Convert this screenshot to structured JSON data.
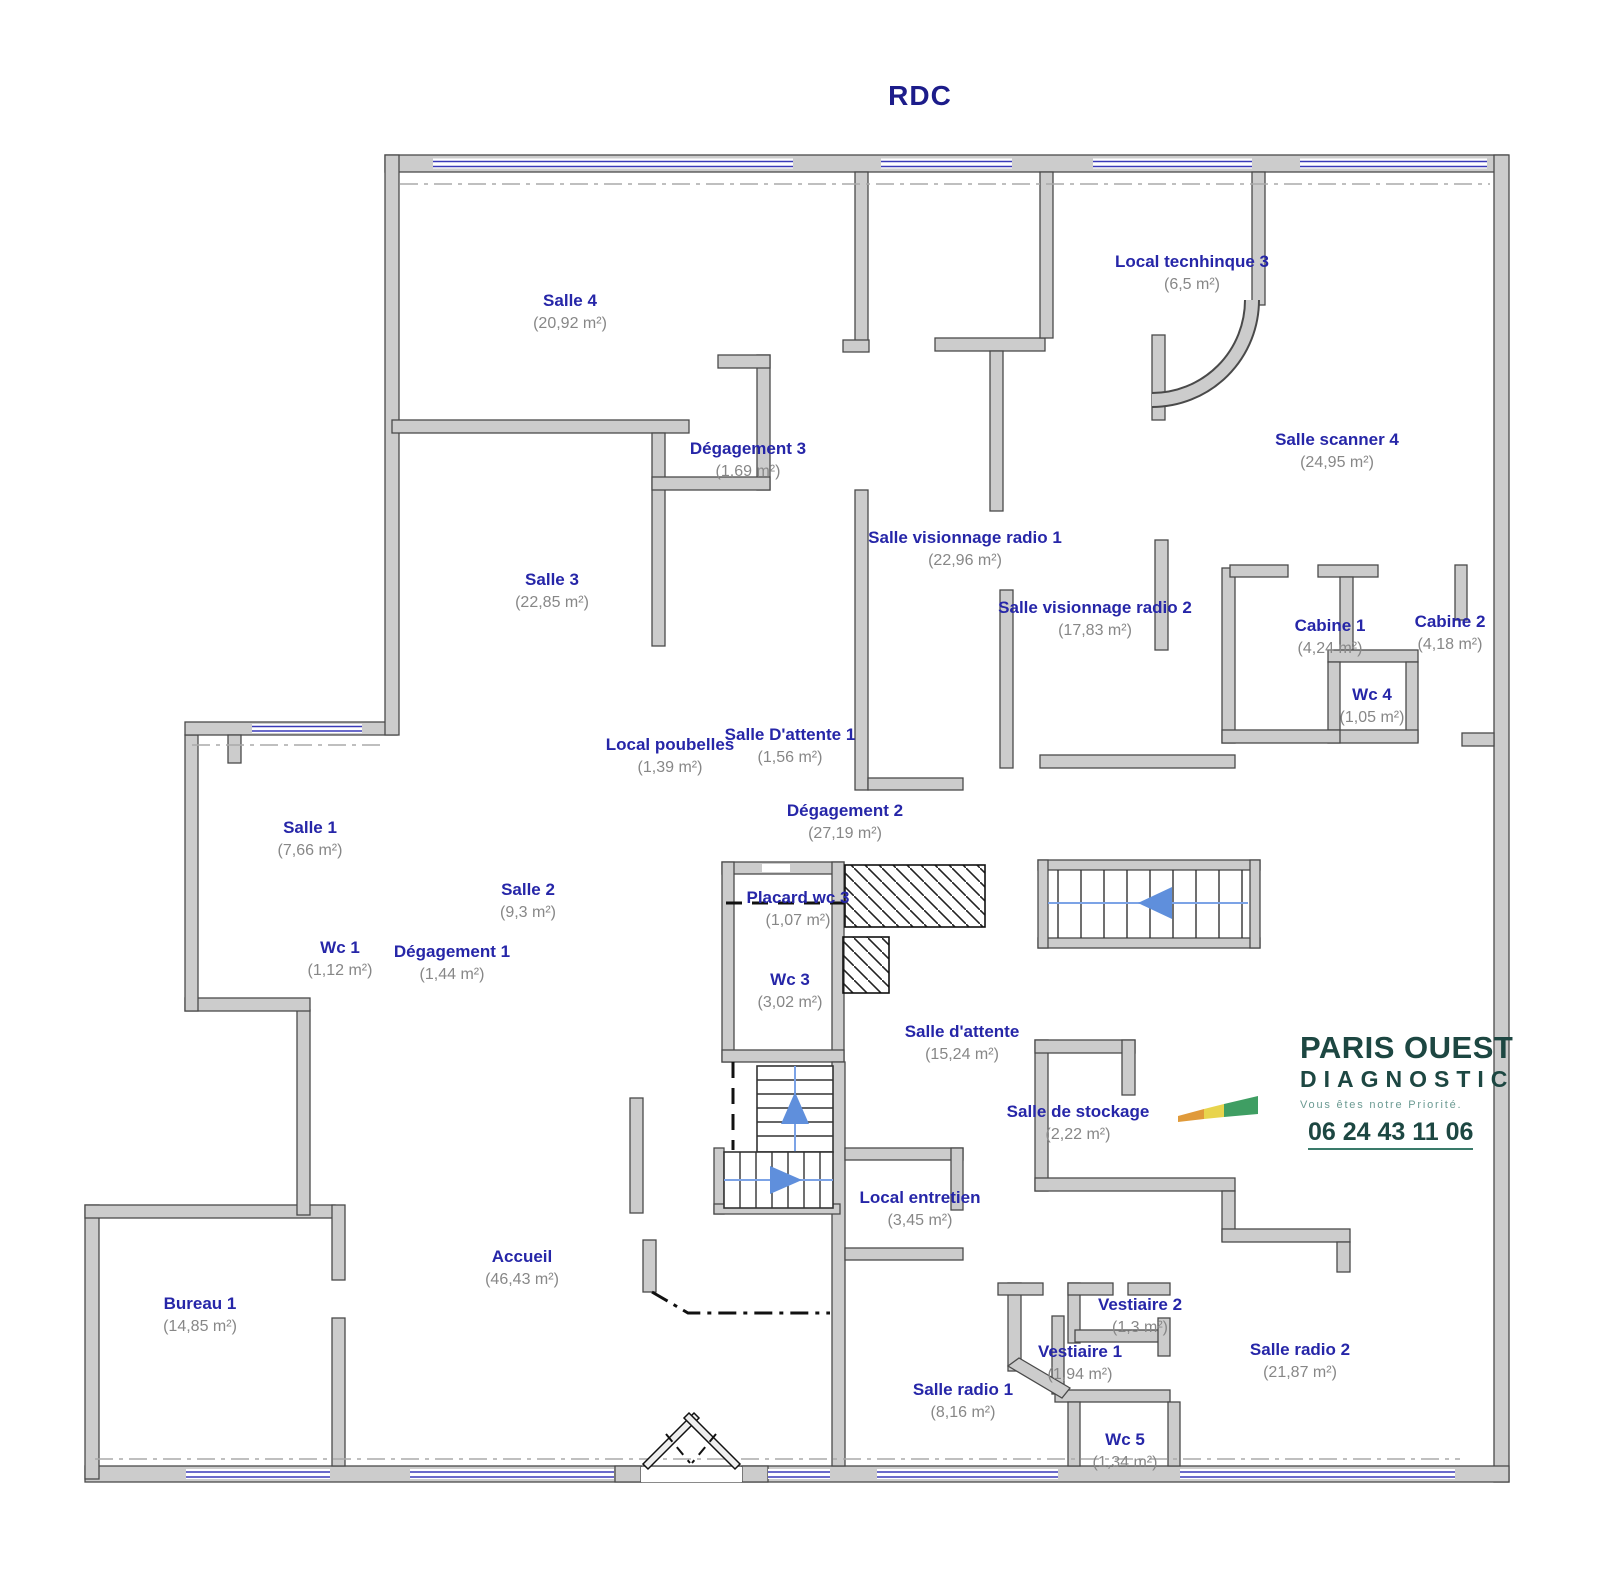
{
  "title": "RDC",
  "rooms": [
    {
      "id": "salle-4",
      "name": "Salle  4",
      "area": "(20,92 m²)",
      "cx": 570,
      "y": 289
    },
    {
      "id": "local-tecnhinque-3",
      "name": "Local tecnhinque 3",
      "area": "(6,5 m²)",
      "cx": 1192,
      "y": 250
    },
    {
      "id": "salle-scanner-4",
      "name": "Salle scanner 4",
      "area": "(24,95 m²)",
      "cx": 1337,
      "y": 428
    },
    {
      "id": "degagement-3",
      "name": "Dégagement 3",
      "area": "(1,69 m²)",
      "cx": 748,
      "y": 437
    },
    {
      "id": "salle-visionnage-radio-1",
      "name": "Salle visionnage radio 1",
      "area": "(22,96 m²)",
      "cx": 965,
      "y": 526
    },
    {
      "id": "salle-3",
      "name": "Salle 3",
      "area": "(22,85 m²)",
      "cx": 552,
      "y": 568
    },
    {
      "id": "salle-visionnage-radio-2",
      "name": "Salle visionnage radio 2",
      "area": "(17,83 m²)",
      "cx": 1095,
      "y": 596
    },
    {
      "id": "cabine-1",
      "name": "Cabine 1",
      "area": "(4,24 m²)",
      "cx": 1330,
      "y": 614
    },
    {
      "id": "cabine-2",
      "name": "Cabine 2",
      "area": "(4,18 m²)",
      "cx": 1450,
      "y": 610
    },
    {
      "id": "wc-4",
      "name": "Wc 4",
      "area": "(1,05 m²)",
      "cx": 1372,
      "y": 683
    },
    {
      "id": "local-poubelles",
      "name": "Local poubelles",
      "area": "(1,39 m²)",
      "cx": 670,
      "y": 733
    },
    {
      "id": "salle-d-attente-1",
      "name": "Salle D'attente  1",
      "area": "(1,56 m²)",
      "cx": 790,
      "y": 723
    },
    {
      "id": "degagement-2",
      "name": "Dégagement 2",
      "area": "(27,19 m²)",
      "cx": 845,
      "y": 799
    },
    {
      "id": "salle-1",
      "name": "Salle 1",
      "area": "(7,66 m²)",
      "cx": 310,
      "y": 816
    },
    {
      "id": "salle-2",
      "name": "Salle 2",
      "area": "(9,3 m²)",
      "cx": 528,
      "y": 878
    },
    {
      "id": "wc-1",
      "name": "Wc 1",
      "area": "(1,12 m²)",
      "cx": 340,
      "y": 936
    },
    {
      "id": "degagement-1",
      "name": "Dégagement 1",
      "area": "(1,44 m²)",
      "cx": 452,
      "y": 940
    },
    {
      "id": "placard-wc-3",
      "name": "Placard wc 3",
      "area": "(1,07 m²)",
      "cx": 798,
      "y": 886
    },
    {
      "id": "wc-3",
      "name": "Wc 3",
      "area": "(3,02 m²)",
      "cx": 790,
      "y": 968
    },
    {
      "id": "salle-d-attente",
      "name": "Salle d'attente",
      "area": "(15,24 m²)",
      "cx": 962,
      "y": 1020
    },
    {
      "id": "salle-de-stockage",
      "name": "Salle de stockage",
      "area": "(2,22 m²)",
      "cx": 1078,
      "y": 1100
    },
    {
      "id": "local-entretien",
      "name": "Local entretien",
      "area": "(3,45 m²)",
      "cx": 920,
      "y": 1186
    },
    {
      "id": "accueil",
      "name": "Accueil",
      "area": "(46,43 m²)",
      "cx": 522,
      "y": 1245
    },
    {
      "id": "bureau-1",
      "name": "Bureau 1",
      "area": "(14,85 m²)",
      "cx": 200,
      "y": 1292
    },
    {
      "id": "vestiaire-2",
      "name": "Vestiaire 2",
      "area": "(1,3 m²)",
      "cx": 1140,
      "y": 1293
    },
    {
      "id": "vestiaire-1",
      "name": "Vestiaire 1",
      "area": "(1,94 m²)",
      "cx": 1080,
      "y": 1340
    },
    {
      "id": "salle-radio-1",
      "name": "Salle radio 1",
      "area": "(8,16 m²)",
      "cx": 963,
      "y": 1378
    },
    {
      "id": "salle-radio-2",
      "name": "Salle radio 2",
      "area": "(21,87 m²)",
      "cx": 1300,
      "y": 1338
    },
    {
      "id": "wc-5",
      "name": "Wc 5",
      "area": "(1,34 m²)",
      "cx": 1125,
      "y": 1428
    }
  ],
  "logo": {
    "line1": "PARIS OUEST",
    "line2": "DIAGNOSTIC",
    "tagline": "Vous êtes notre Priorité.",
    "phone": "06 24 43 11 06"
  },
  "colors": {
    "room_label_blue": "#2626a8",
    "area_label_gray": "#878787",
    "wall_fill": "#cccccc",
    "wall_edge": "#4a4a4a",
    "window_blue": "#3a3ab8",
    "stair_arrow_blue": "#7ca3e6",
    "logo_teal": "#1d4742",
    "title_navy": "#1c1c8a"
  }
}
